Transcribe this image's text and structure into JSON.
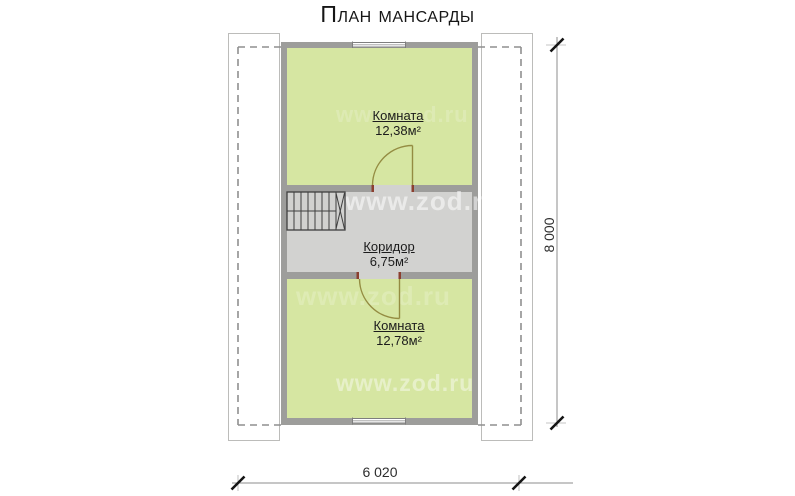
{
  "title": "План мансарды",
  "watermark_text": "www.zod.ru",
  "rooms": {
    "upper": {
      "label": "Комната",
      "area": "12,38м²"
    },
    "corridor": {
      "label": "Коридор",
      "area": "6,75м²"
    },
    "lower": {
      "label": "Комната",
      "area": "12,78м²"
    }
  },
  "dimensions": {
    "horizontal": "6 020",
    "vertical": "8 000"
  },
  "colors": {
    "room_fill": "#d6e6a2",
    "wall": "#9d9d9b",
    "corridor_fill": "#d2d2d0",
    "stair_fill": "#d1d1cf",
    "door_swing": "#948c42",
    "door_jamb": "#8b3f2f",
    "roof_outline_dash": "#8f8f8f",
    "dimension_line": "#8c8c8c",
    "dimension_tick": "#151515",
    "text": "#1c1c1c"
  }
}
